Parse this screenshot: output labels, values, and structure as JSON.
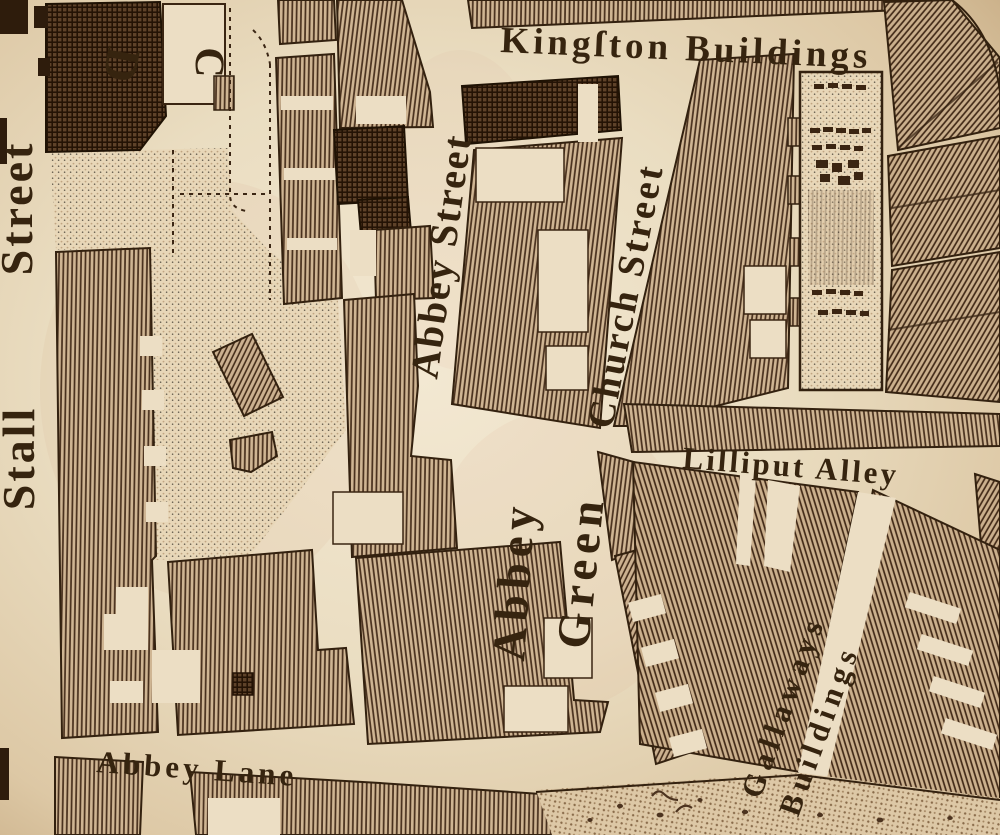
{
  "map": {
    "type": "engraved-street-map",
    "palette": {
      "paper": "#ecdec4",
      "ink": "#36240f",
      "hatch_line": "#472f1c",
      "hatch_bg": "#cfb593",
      "dark_block": "#241305"
    },
    "labels": {
      "kingston_buildings": "Kingſton Buildings",
      "stall_street_word1": "Stall",
      "stall_street_word2": "Street",
      "abbey_street": "Abbey Street",
      "church_street": "Church Street",
      "abbey_green_word1": "Abbey",
      "abbey_green_word2": "Green",
      "lilliput_alley": "Lilliput Alley",
      "gallaways_word1": "Gallaways",
      "gallaways_word2": "Buildings",
      "abbey_lane": "Abbey Lane",
      "key_letter_c": "C",
      "key_letter_d": "D"
    }
  }
}
